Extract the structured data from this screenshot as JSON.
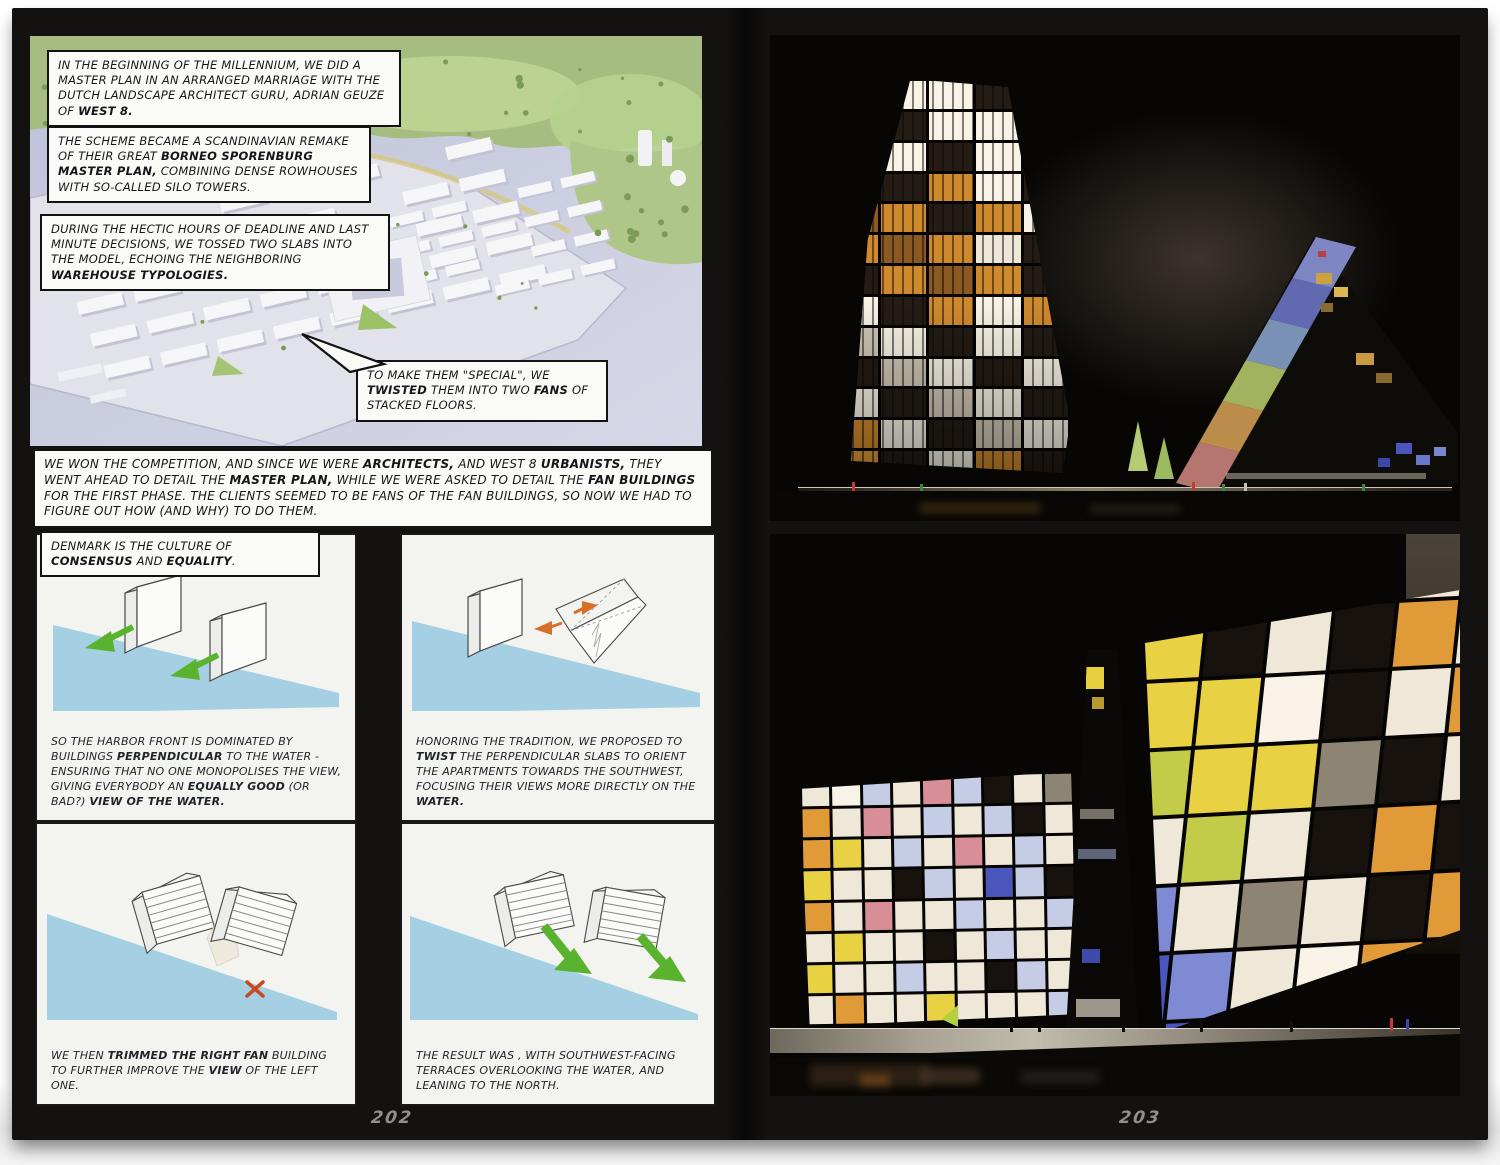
{
  "book": {
    "left_page_number": "202",
    "right_page_number": "203",
    "page_background": "#131211"
  },
  "left_page": {
    "box1": [
      {
        "t": "IN THE BEGINNING OF THE MILLENNIUM, WE DID A MASTER PLAN IN AN ARRANGED MARRIAGE WITH THE DUTCH LANDSCAPE ARCHITECT GURU, ADRIAN GEUZE OF "
      },
      {
        "t": "WEST 8.",
        "b": true
      }
    ],
    "box2": [
      {
        "t": "THE SCHEME BECAME A SCANDINAVIAN REMAKE OF THEIR GREAT "
      },
      {
        "t": "BORNEO SPORENBURG MASTER PLAN,",
        "b": true
      },
      {
        "t": " COMBINING DENSE ROWHOUSES WITH SO-CALLED SILO TOWERS."
      }
    ],
    "box3": [
      {
        "t": "DURING THE HECTIC HOURS OF DEADLINE AND LAST MINUTE DECISIONS, WE TOSSED TWO SLABS INTO THE MODEL, ECHOING THE NEIGHBORING "
      },
      {
        "t": "WAREHOUSE TYPOLOGIES.",
        "b": true
      }
    ],
    "bubble": [
      {
        "t": "TO MAKE THEM \"SPECIAL\", WE "
      },
      {
        "t": "TWISTED",
        "b": true
      },
      {
        "t": " THEM INTO TWO "
      },
      {
        "t": "FANS",
        "b": true
      },
      {
        "t": " OF STACKED FLOORS."
      }
    ],
    "box4": [
      {
        "t": "WE WON THE COMPETITION, AND SINCE WE WERE "
      },
      {
        "t": "ARCHITECTS,",
        "b": true
      },
      {
        "t": " AND WEST 8 "
      },
      {
        "t": "URBANISTS,",
        "b": true
      },
      {
        "t": " THEY WENT AHEAD TO DETAIL THE "
      },
      {
        "t": "MASTER PLAN,",
        "b": true
      },
      {
        "t": " WHILE WE WERE ASKED TO DETAIL THE "
      },
      {
        "t": "FAN BUILDINGS",
        "b": true
      },
      {
        "t": " FOR THE FIRST PHASE. THE CLIENTS SEEMED TO BE FANS OF THE FAN BUILDINGS, SO NOW WE HAD TO FIGURE OUT HOW (AND WHY) TO DO THEM."
      }
    ],
    "denmark": [
      {
        "t": "DENMARK IS THE CULTURE OF "
      },
      {
        "t": "CONSENSUS",
        "b": true
      },
      {
        "t": " AND "
      },
      {
        "t": "EQUALITY",
        "b": true
      },
      {
        "t": "."
      }
    ],
    "panel1": [
      {
        "t": "SO THE HARBOR FRONT IS DOMINATED BY BUILDINGS "
      },
      {
        "t": "PERPENDICULAR",
        "b": true
      },
      {
        "t": " TO THE WATER - ENSURING THAT NO ONE MONOPOLISES THE VIEW, GIVING EVERYBODY AN "
      },
      {
        "t": "EQUALLY GOOD",
        "b": true
      },
      {
        "t": " (OR BAD?) "
      },
      {
        "t": "VIEW OF THE WATER.",
        "b": true
      }
    ],
    "panel2": [
      {
        "t": "HONORING THE TRADITION, WE PROPOSED TO "
      },
      {
        "t": "TWIST",
        "b": true
      },
      {
        "t": " THE PERPENDICULAR SLABS TO ORIENT THE APARTMENTS TOWARDS THE SOUTHWEST, FOCUSING THEIR VIEWS MORE DIRECTLY ON THE "
      },
      {
        "t": "WATER.",
        "b": true
      }
    ],
    "panel3": [
      {
        "t": "WE THEN "
      },
      {
        "t": "TRIMMED THE RIGHT FAN",
        "b": true
      },
      {
        "t": " BUILDING TO FURTHER IMPROVE THE "
      },
      {
        "t": "VIEW",
        "b": true
      },
      {
        "t": " OF THE LEFT ONE."
      }
    ],
    "panel4": [
      {
        "t": "THE RESULT WAS , WITH SOUTHWEST-FACING TERRACES OVERLOOKING THE WATER, AND LEANING TO THE NORTH."
      }
    ]
  },
  "photos": {
    "legend": {
      "k": "#17120e",
      "n": "#241c15",
      "w": "#efe8d8",
      "W": "#f8f3e6",
      "m": "#cfc6b4",
      "s": "#8d8474",
      "a": "#d08a2e",
      "A": "#8a5a22",
      "o": "#e09a38",
      "y": "#e8d244",
      "g": "#c2cc48",
      "b": "#4a56bc",
      "B": "#7e8ad4",
      "c": "#c5cde6",
      "p": "#d88e96",
      "r": "#c04038",
      "x": "#5a5248"
    },
    "tower_left_grid": [
      "nWWnW",
      "WnWWa",
      "nWnWW",
      "anaWn",
      "AanaW",
      "aAawn",
      "naAan",
      "WnaWa",
      "mWnWn",
      "nmWnW",
      "WnmWn",
      "aWnmW",
      "onWan"
    ],
    "sail_band_colors": [
      "#c8827c",
      "#cf9a52",
      "#b4c468",
      "#84a0c8",
      "#6a74c4",
      "#8a94d8"
    ],
    "slab_left_grid": [
      "wWcwpckws",
      "owpwcwckw",
      "oywcwpwcw",
      "ywwkcwbck",
      "owpwwcwwc",
      "wywwkwcww",
      "ywwcwwkcw",
      "wowwywwwc"
    ],
    "slab_right_grid": [
      "koWkowk",
      "oykwkow",
      "kyyWkwo",
      "wgyyskw",
      "swgwkok",
      "bBwswko",
      "bbBwWos",
      "wWbwwww"
    ],
    "aerial_colors": {
      "water": "#c6c8dc",
      "water_light": "#d6d8e8",
      "green": "#a6bd82",
      "green_light": "#cde2a4",
      "park": "#aec687",
      "model": "#e2e2ea",
      "block": "#f6f6f9",
      "block_shadow": "#c3c3d4",
      "quay": "#d6c87e",
      "tree": "#7c9c56",
      "lime": "#9cc268"
    },
    "diagram_colors": {
      "water": "#a5cfe3",
      "slab": "#fbfbfa",
      "outline": "#4a4a4a",
      "green_arrow": "#5ab32e",
      "orange_arrow": "#d86f28",
      "red_x": "#c64a22"
    }
  }
}
